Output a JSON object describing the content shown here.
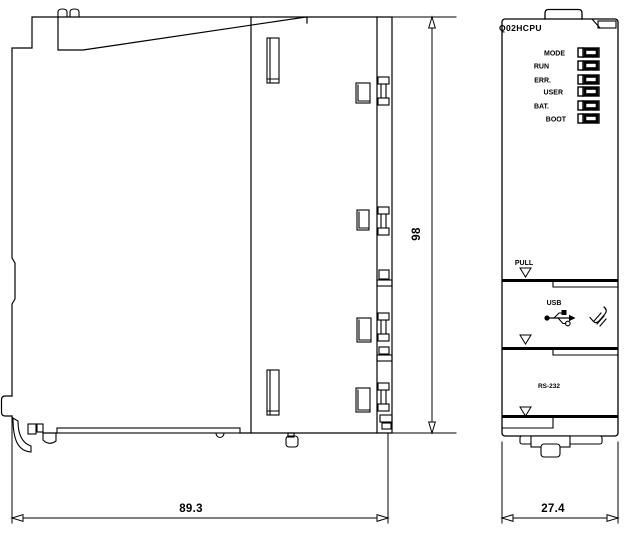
{
  "drawing": {
    "kind": "plc-module-dimension-drawing",
    "colors": {
      "line": "#000000",
      "background": "#ffffff"
    }
  },
  "views": {
    "side": {
      "name": "side view"
    },
    "front": {
      "model": "Q02HCPU",
      "leds": [
        "MODE",
        "RUN",
        "ERR.",
        "USER",
        "BAT.",
        "BOOT"
      ],
      "pull": "PULL",
      "usb": "USB",
      "serial": "RS-232"
    }
  },
  "dimensions": {
    "depth": "89.3",
    "height": "98",
    "width": "27.4"
  },
  "icons": {
    "usb": "usb-trident-icon",
    "hand": "press-hand-icon",
    "marker": "down-triangle-marker",
    "hooks": "mounting-hook",
    "latch": "din-rail-latch"
  }
}
